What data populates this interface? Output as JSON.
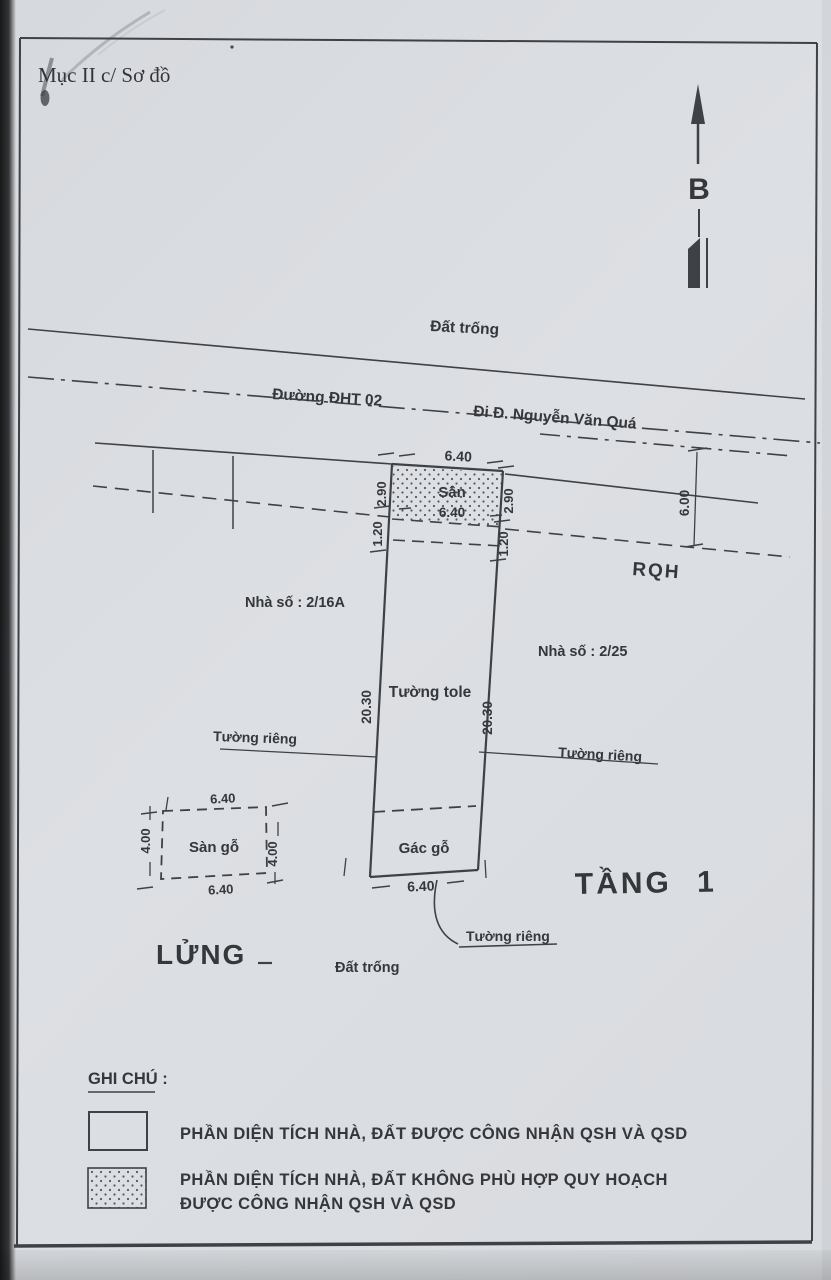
{
  "document": {
    "section_title": "Mục II c/ Sơ đồ"
  },
  "compass": {
    "north_label": "B"
  },
  "road": {
    "vacant_land_top": "Đất trống",
    "street_name": "Đường ĐHT 02",
    "direction_note": "Đi Đ. Nguyễn Văn Quá",
    "planning_boundary_label": "RQH",
    "planning_width": "6.00"
  },
  "neighbors": {
    "left_house": "Nhà số : 2/16A",
    "right_house": "Nhà số : 2/25"
  },
  "plot": {
    "yard_label": "Sân",
    "front_width": "6.40",
    "yard_inner_width": "6.40",
    "rear_width": "6.40",
    "side_depth": "20.30",
    "yard_depth": "2.90",
    "setback_depth": "1.20",
    "wall_material_label": "Tường tole",
    "attic_label": "Gác gỗ",
    "private_wall_label": "Tường riêng"
  },
  "mezzanine": {
    "title": "LỬNG",
    "floor_label": "Sàn gỗ",
    "width": "6.40",
    "depth": "4.00"
  },
  "floor_one": {
    "title": "TẦNG 1",
    "vacant_land_bottom": "Đất trống"
  },
  "legend": {
    "title": "GHI CHÚ :",
    "item1": "PHẦN DIỆN TÍCH NHÀ, ĐẤT ĐƯỢC CÔNG NHẬN QSH VÀ QSD",
    "item2_line1": "PHẦN DIỆN TÍCH NHÀ, ĐẤT KHÔNG PHÙ HỢP QUY HOẠCH",
    "item2_line2": "ĐƯỢC CÔNG NHẬN QSH VÀ QSD"
  },
  "colors": {
    "paper": "#dadde1",
    "ink": "#35373a"
  }
}
